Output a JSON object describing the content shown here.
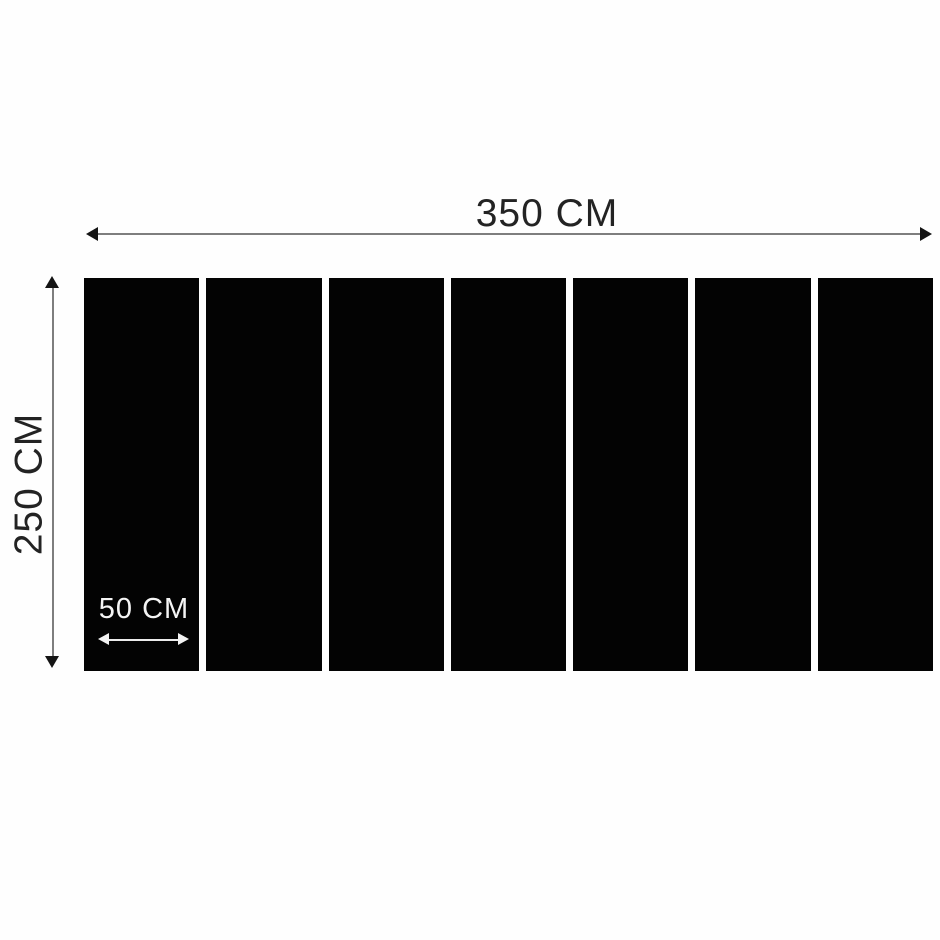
{
  "diagram": {
    "width_dimension": {
      "label": "350 CM"
    },
    "height_dimension": {
      "label": "250 CM"
    },
    "panel_dimension": {
      "label": "50 CM"
    },
    "panel_count": 7,
    "colors": {
      "background": "#fefefe",
      "panel_black": "#030303",
      "dim_text": "#232323",
      "dim_line": "#7e7e7e",
      "arrowhead": "#141414",
      "light_text": "#f4f4f4",
      "light_line": "#ececec"
    }
  }
}
